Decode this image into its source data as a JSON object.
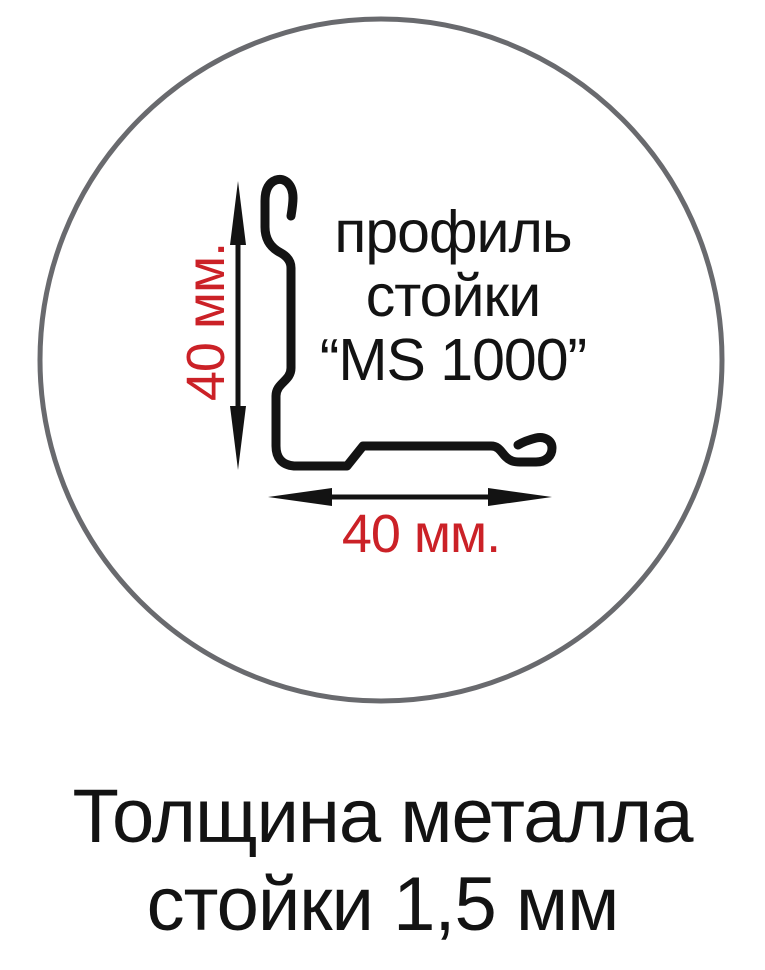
{
  "diagram": {
    "profile_label": {
      "line1": "профиль",
      "line2": "стойки",
      "line3": "“MS 1000”"
    },
    "vertical_dimension": "40 мм.",
    "horizontal_dimension": "40 мм."
  },
  "caption": {
    "line1": "Толщина металла",
    "line2": "стойки 1,5 мм"
  },
  "colors": {
    "dimension_red": "#cb2127",
    "circle_gray": "#696a6e",
    "drawing_black": "#131313"
  }
}
